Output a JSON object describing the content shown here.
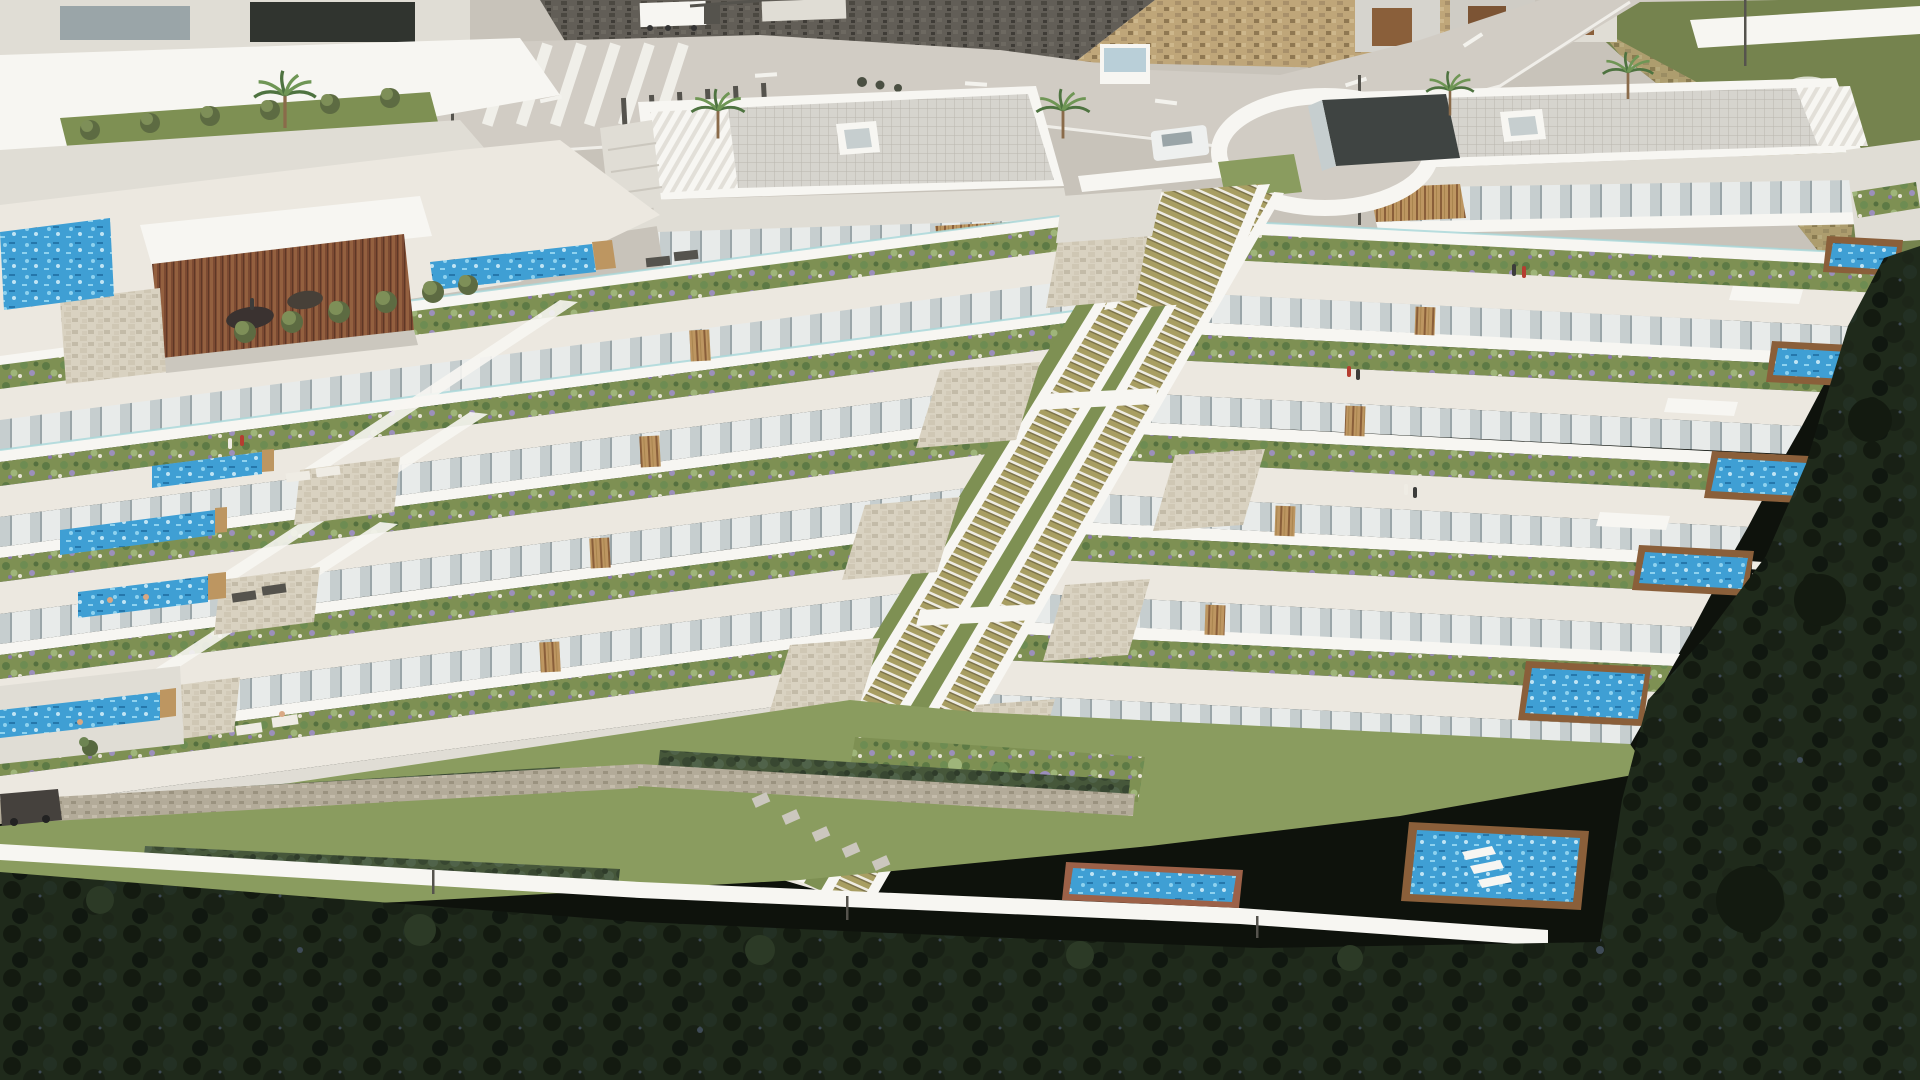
{
  "scene": {
    "title": "Aerial 3D rendering of a terraced hillside apartment complex",
    "view": "high-angle aerial, late afternoon sun",
    "setting": "Modern white stepped residential development built into a steep coastal hillside; asphalt road with stone retaining walls above, dense dark pine forest below",
    "features": [
      "stepped terraces with planted balcony gardens",
      "private plunge pools with wooden copings",
      "long lap pools on left terraces",
      "two communal pools at garden level",
      "twin diagonal outdoor staircases through the center",
      "circular entrance rotunda with dark pavilion",
      "penthouse blocks with gridded flat roofs and skylights",
      "palm trees along the road",
      "gabion stone walls and hedges at the lower boundary"
    ],
    "counts": {
      "terrace_levels": 6,
      "private_pools": 11,
      "communal_pools": 2,
      "central_staircases": 2,
      "palm_trees": 5,
      "people_visible": 13,
      "vehicles": 5
    }
  },
  "colors": {
    "pavement": "#c8c3ba",
    "road": "#d1ccc4",
    "kerb": "#e6e2da",
    "lane_mark": "#f3f2ed",
    "stone_tan": "#bfa679",
    "stone_dark": "#625e57",
    "hill_green": "#75834e",
    "white_bright": "#f7f6f2",
    "white_shade": "#e0ddd5",
    "white_deep": "#cbc7be",
    "roof_gray": "#d6d4ce",
    "roof_grid": "#b9b6af",
    "glass_light": "#e8ebea",
    "glass_mid": "#c6cecf",
    "glass_dark": "#9aa5a8",
    "win_dark": "#30342f",
    "wood": "#bd9661",
    "wood_dark": "#8a5f3a",
    "slat_brown": "#7c4a32",
    "terrace_floor": "#ece8e0",
    "stone_clad": "#d9d2c1",
    "gabion": "#b3ab99",
    "planter_grass": "#7e9053",
    "bush_green": "#5d7a45",
    "bush_light": "#9fb57a",
    "bush_purple": "#9c8fbc",
    "pebble": "#e9e4d8",
    "lawn": "#8a9c5f",
    "hedge": "#46573a",
    "pool_blue": "#3f9fd4",
    "pool_light": "#8ed2ef",
    "pool_deep": "#2577ab",
    "glass_teal": "#a8d8da",
    "stair_step": "#a89e62",
    "stair_shadow": "#7d744b",
    "forest": "#1f2a1b",
    "forest_dark": "#131a10",
    "forest_glow": "#2c3a26",
    "rock_glint": "#3e4a56",
    "brick": "#9c6148",
    "car_white": "#eef0ef",
    "car_dark": "#45413d",
    "truck_blue": "#2e6db4",
    "metal_dark": "#55534d",
    "pavilion_dark": "#3f4442",
    "person_red": "#b53d30",
    "person_white": "#efece4",
    "person_dark": "#3c3c3a",
    "skin": "#d9a884",
    "palm_leaf": "#4e7340",
    "palm_leaf_light": "#6f9655",
    "palm_trunk": "#8a6b4a"
  }
}
